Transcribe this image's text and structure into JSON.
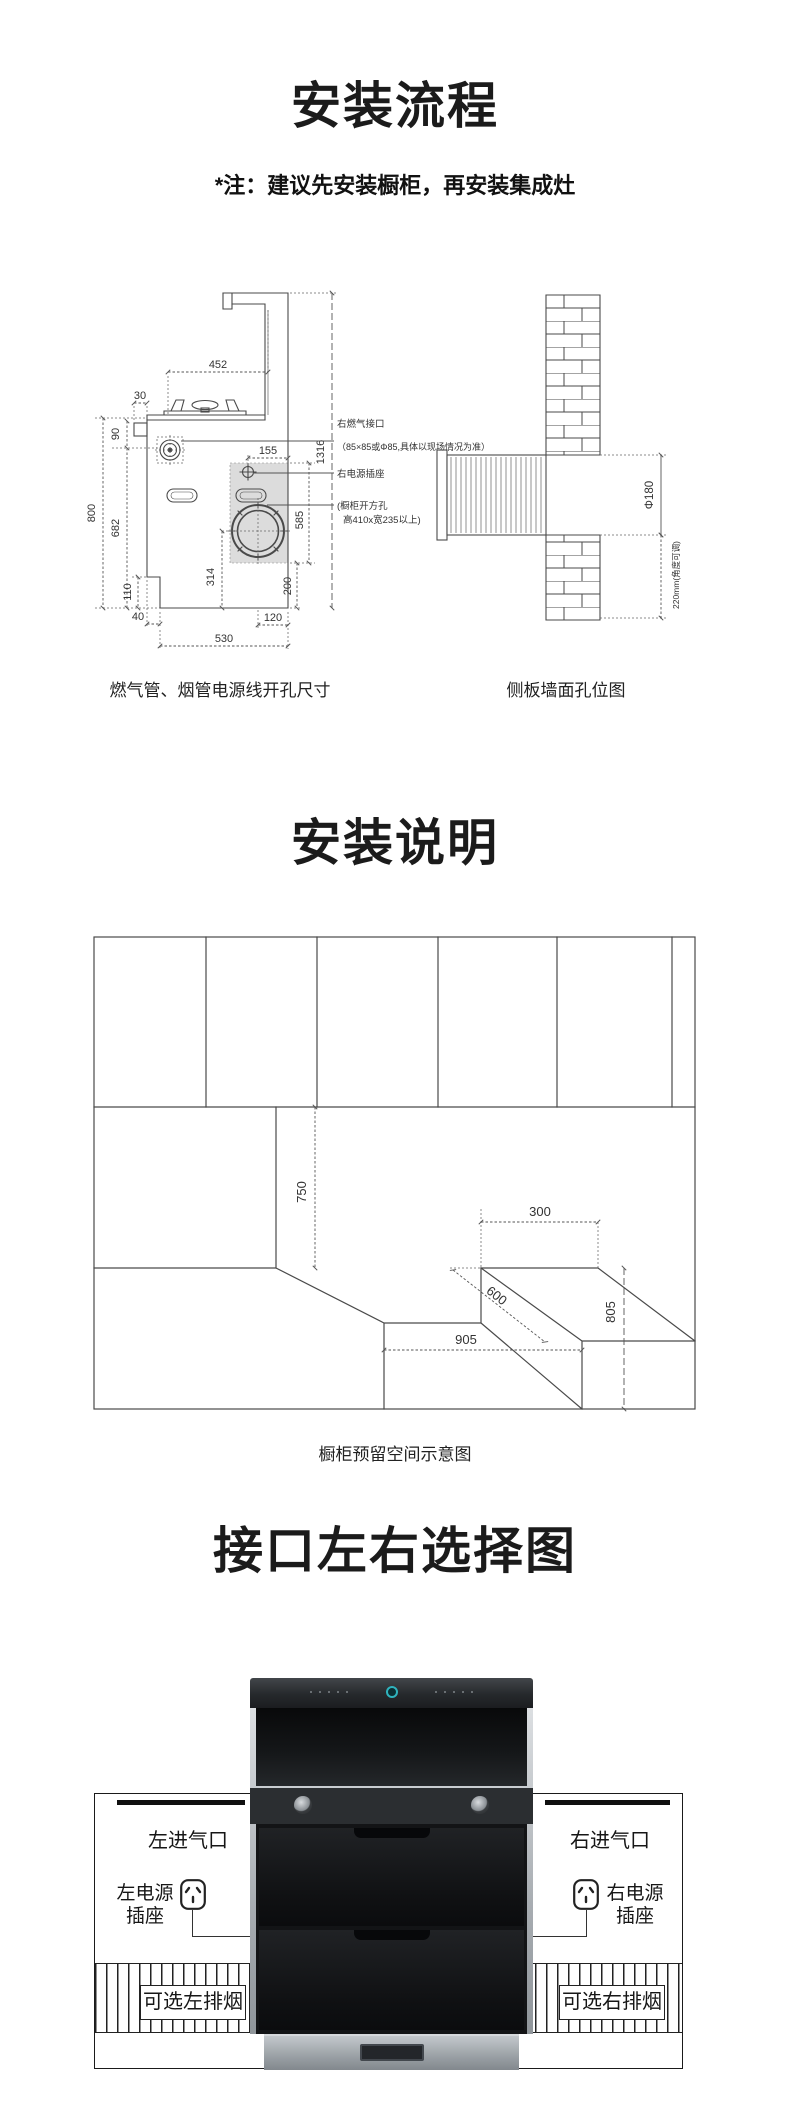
{
  "colors": {
    "line": "#4a4a4a",
    "dim_text": "#333333",
    "shade_gray": "#dcdcdc",
    "display_teal": "#2fb3bd",
    "box_border": "#1a1a1a",
    "black_bar": "#101010"
  },
  "section1": {
    "title": "安装流程",
    "note": "*注：建议先安装橱柜，再安装集成灶",
    "stove": {
      "caption": "燃气管、烟管电源线开孔尺寸",
      "dims": {
        "top_width": "452",
        "knob_offset": "30",
        "knob_height": "90",
        "counter_height": "800",
        "gas_height": "682",
        "toekick_height": "110",
        "toekick_depth": "40",
        "base_depth": "530",
        "flue_center_height": "314",
        "flue_center_offset": "120",
        "flue_bottom": "200",
        "cutout_height": "585",
        "socket_offset": "155",
        "total_height": "1316"
      },
      "annotations": {
        "gas_port": "右燃气接口",
        "gas_port_spec": "（85×85或Φ85,具体以现场情况为准）",
        "power_socket": "右电源插座",
        "cabinet_hole_1": "(橱柜开方孔",
        "cabinet_hole_2": "高410x宽235以上)"
      }
    },
    "wall": {
      "caption": "侧板墙面孔位图",
      "dims": {
        "hole_dia": "Φ180",
        "hole_height": "220mm(角度可调)"
      }
    }
  },
  "section2": {
    "title": "安装说明",
    "caption": "橱柜预留空间示意图",
    "dims": {
      "upper_gap": "750",
      "side_gap": "300",
      "depth": "600",
      "slot_width": "905",
      "counter_height": "805"
    }
  },
  "section3": {
    "title": "接口左右选择图",
    "left": {
      "inlet": "左进气口",
      "power_line1": "左电源",
      "power_line2": "插座",
      "exhaust": "可选左排烟"
    },
    "right": {
      "inlet": "右进气口",
      "power_line1": "右电源",
      "power_line2": "插座",
      "exhaust": "可选右排烟"
    }
  }
}
